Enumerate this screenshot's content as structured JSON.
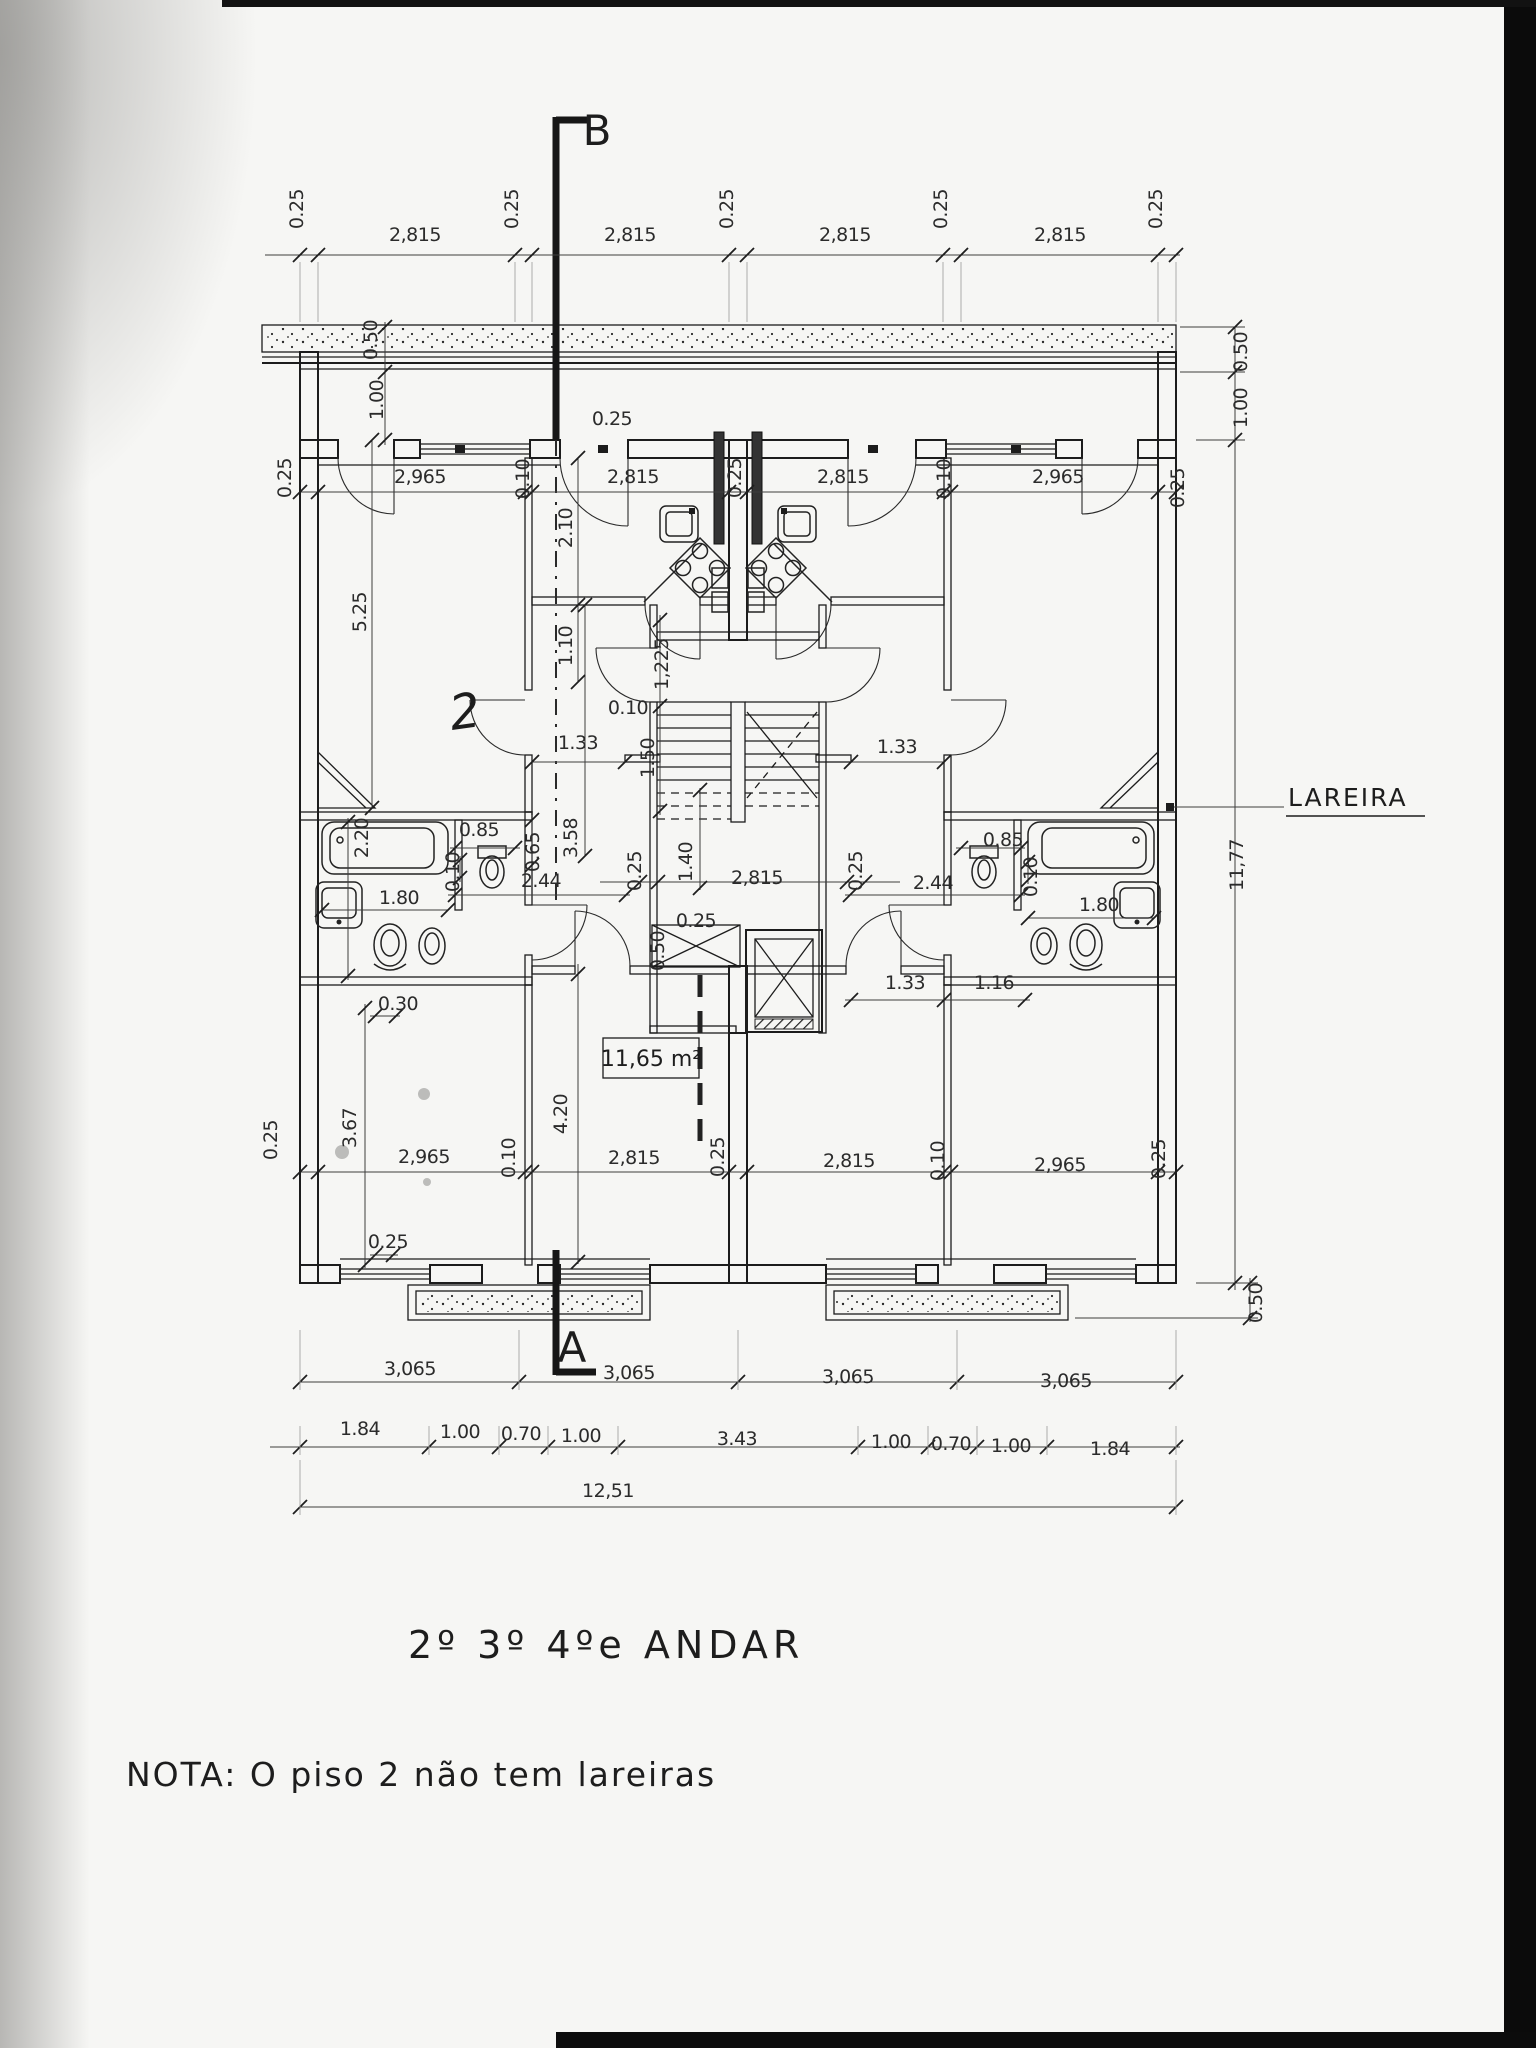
{
  "page": {
    "paper_color": "#f6f6f4",
    "ink_color": "#1f1f1f"
  },
  "plan": {
    "title": "2º 3º 4ºe ANDAR",
    "note": "NOTA: O piso 2 não tem lareiras",
    "section_marker_top": "B",
    "section_marker_bottom": "A",
    "fireplace_callout": "LAREIRA",
    "room_area_label": "11,65 m²",
    "handwritten_mark": "2",
    "overall_width": "12,51",
    "overall_height": "11,77",
    "dimension_labels": [
      {
        "t": "0.25",
        "x": 303,
        "y": 209,
        "r": -90
      },
      {
        "t": "2,815",
        "x": 415,
        "y": 241
      },
      {
        "t": "0.25",
        "x": 518,
        "y": 209,
        "r": -90
      },
      {
        "t": "2,815",
        "x": 630,
        "y": 241
      },
      {
        "t": "0.25",
        "x": 733,
        "y": 209,
        "r": -90
      },
      {
        "t": "2,815",
        "x": 845,
        "y": 241
      },
      {
        "t": "0.25",
        "x": 947,
        "y": 209,
        "r": -90
      },
      {
        "t": "2,815",
        "x": 1060,
        "y": 241
      },
      {
        "t": "0.25",
        "x": 1162,
        "y": 209,
        "r": -90
      },
      {
        "t": "0.50",
        "x": 1247,
        "y": 352,
        "r": -90
      },
      {
        "t": "1.00",
        "x": 1247,
        "y": 408,
        "r": -90
      },
      {
        "t": "11,77",
        "x": 1243,
        "y": 865,
        "r": -90
      },
      {
        "t": "0.50",
        "x": 1262,
        "y": 1303,
        "r": -90
      },
      {
        "t": "0.50",
        "x": 377,
        "y": 340,
        "r": -90,
        "s": 15
      },
      {
        "t": "1.00",
        "x": 383,
        "y": 400,
        "r": -90,
        "s": 18
      },
      {
        "t": "0.25",
        "x": 291,
        "y": 478,
        "r": -90
      },
      {
        "t": "2,965",
        "x": 420,
        "y": 483
      },
      {
        "t": "0.10",
        "x": 529,
        "y": 479,
        "r": -90
      },
      {
        "t": "2,815",
        "x": 633,
        "y": 483
      },
      {
        "t": "0.25",
        "x": 741,
        "y": 478,
        "r": -90
      },
      {
        "t": "2,815",
        "x": 843,
        "y": 483
      },
      {
        "t": "0.10",
        "x": 950,
        "y": 479,
        "r": -90
      },
      {
        "t": "2,965",
        "x": 1058,
        "y": 483
      },
      {
        "t": "0.25",
        "x": 1184,
        "y": 488,
        "r": -90
      },
      {
        "t": "0.25",
        "x": 612,
        "y": 425
      },
      {
        "t": "5.25",
        "x": 366,
        "y": 612,
        "r": -90
      },
      {
        "t": "2.10",
        "x": 572,
        "y": 528,
        "r": -90
      },
      {
        "t": "1.10",
        "x": 572,
        "y": 646,
        "r": -90
      },
      {
        "t": "0.10",
        "x": 628,
        "y": 714
      },
      {
        "t": "1.33",
        "x": 578,
        "y": 749
      },
      {
        "t": "1.33",
        "x": 897,
        "y": 753
      },
      {
        "t": "1,225",
        "x": 668,
        "y": 664,
        "r": -90,
        "s": 19
      },
      {
        "t": "1.50",
        "x": 654,
        "y": 758,
        "r": -90
      },
      {
        "t": "3.58",
        "x": 577,
        "y": 838,
        "r": -90,
        "s": 18
      },
      {
        "t": "1.40",
        "x": 692,
        "y": 862,
        "r": -90
      },
      {
        "t": "2,815",
        "x": 757,
        "y": 884
      },
      {
        "t": "0.25",
        "x": 641,
        "y": 871,
        "r": -90,
        "s": 18
      },
      {
        "t": "0.25",
        "x": 862,
        "y": 871,
        "r": -90,
        "s": 18
      },
      {
        "t": "0.25",
        "x": 696,
        "y": 927,
        "s": 17
      },
      {
        "t": "0.50",
        "x": 664,
        "y": 951,
        "r": -90,
        "s": 17
      },
      {
        "t": "2.20",
        "x": 368,
        "y": 838,
        "r": -90
      },
      {
        "t": "1.80",
        "x": 399,
        "y": 904
      },
      {
        "t": "0.30",
        "x": 398,
        "y": 1010
      },
      {
        "t": "0.85",
        "x": 479,
        "y": 836
      },
      {
        "t": "0.65",
        "x": 539,
        "y": 852,
        "r": -90,
        "s": 18
      },
      {
        "t": "2.44",
        "x": 541,
        "y": 887
      },
      {
        "t": "0.10",
        "x": 459,
        "y": 872,
        "r": -90,
        "s": 16
      },
      {
        "t": "0.85",
        "x": 1003,
        "y": 846
      },
      {
        "t": "0.10",
        "x": 1037,
        "y": 877,
        "r": -90,
        "s": 16
      },
      {
        "t": "1.80",
        "x": 1099,
        "y": 911
      },
      {
        "t": "2.44",
        "x": 933,
        "y": 889
      },
      {
        "t": "1.33",
        "x": 905,
        "y": 989
      },
      {
        "t": "1.16",
        "x": 994,
        "y": 989
      },
      {
        "t": "0.25",
        "x": 277,
        "y": 1140,
        "r": -90
      },
      {
        "t": "3.67",
        "x": 356,
        "y": 1128,
        "r": -90
      },
      {
        "t": "2,965",
        "x": 424,
        "y": 1163
      },
      {
        "t": "0.10",
        "x": 515,
        "y": 1158,
        "r": -90
      },
      {
        "t": "4.20",
        "x": 567,
        "y": 1114,
        "r": -90
      },
      {
        "t": "2,815",
        "x": 634,
        "y": 1164
      },
      {
        "t": "0.25",
        "x": 724,
        "y": 1157,
        "r": -90
      },
      {
        "t": "2,815",
        "x": 849,
        "y": 1167
      },
      {
        "t": "0.10",
        "x": 944,
        "y": 1161,
        "r": -90
      },
      {
        "t": "2,965",
        "x": 1060,
        "y": 1171
      },
      {
        "t": "0.25",
        "x": 1165,
        "y": 1159,
        "r": -90
      },
      {
        "t": "0.25",
        "x": 388,
        "y": 1248
      },
      {
        "t": "3,065",
        "x": 410,
        "y": 1375
      },
      {
        "t": "3,065",
        "x": 629,
        "y": 1379
      },
      {
        "t": "3,065",
        "x": 848,
        "y": 1383
      },
      {
        "t": "3,065",
        "x": 1066,
        "y": 1387
      },
      {
        "t": "1.84",
        "x": 360,
        "y": 1435
      },
      {
        "t": "1.00",
        "x": 460,
        "y": 1438
      },
      {
        "t": "0.70",
        "x": 521,
        "y": 1440
      },
      {
        "t": "1.00",
        "x": 581,
        "y": 1442
      },
      {
        "t": "3.43",
        "x": 737,
        "y": 1445
      },
      {
        "t": "1.00",
        "x": 891,
        "y": 1448
      },
      {
        "t": "0.70",
        "x": 951,
        "y": 1450
      },
      {
        "t": "1.00",
        "x": 1011,
        "y": 1452
      },
      {
        "t": "1.84",
        "x": 1110,
        "y": 1455
      },
      {
        "t": "12,51",
        "x": 608,
        "y": 1497
      }
    ]
  }
}
